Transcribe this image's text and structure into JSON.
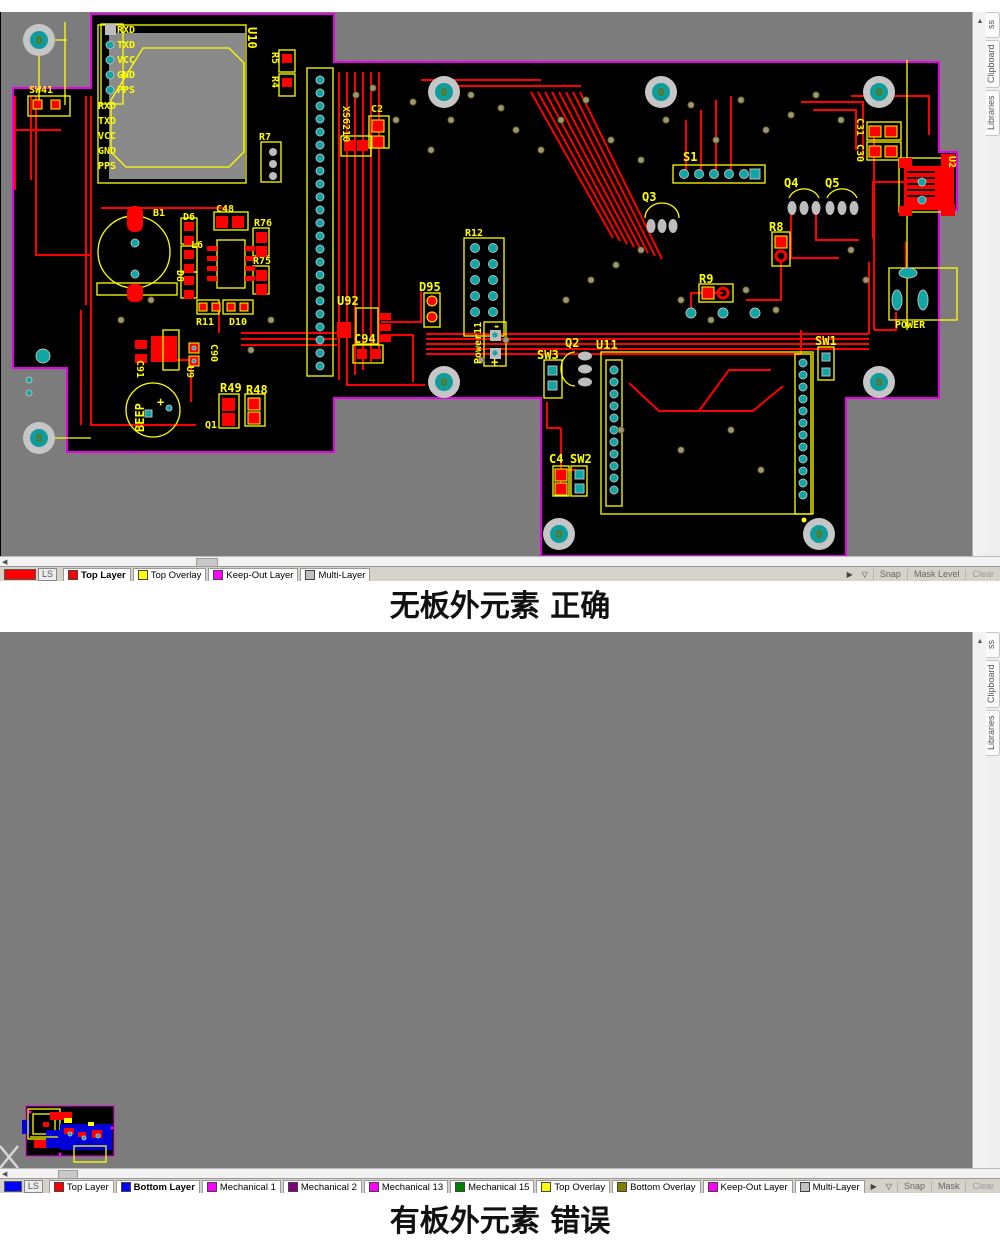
{
  "app": {
    "side_tabs": {
      "clipped": "ss",
      "clipboard": "Clipboard",
      "libraries": "Libraries"
    },
    "scroll": {
      "up": "▲",
      "left": "◀"
    },
    "buttons": {
      "snap": "Snap",
      "mask_level": "Mask Level",
      "clear": "Clear"
    },
    "icons": {
      "pick": "▶",
      "funnel": "▽"
    }
  },
  "panel1": {
    "caption": "无板外元素 正确",
    "indicator": "LS",
    "swatch": "#FF0000",
    "tabs": [
      {
        "label": "Top Layer",
        "color": "#FF0000",
        "active": true
      },
      {
        "label": "Top Overlay",
        "color": "#FFFF00",
        "active": false
      },
      {
        "label": "Keep-Out Layer",
        "color": "#FF00FF",
        "active": false
      },
      {
        "label": "Multi-Layer",
        "color": "#C0C0C0",
        "active": false
      }
    ]
  },
  "panel2": {
    "caption": "有板外元素 错误",
    "indicator": "LS",
    "swatch": "#0000FF",
    "tabs": [
      {
        "label": "Top Layer",
        "color": "#FF0000",
        "active": false
      },
      {
        "label": "Bottom Layer",
        "color": "#0000FF",
        "active": true
      },
      {
        "label": "Mechanical 1",
        "color": "#FF00FF",
        "active": false
      },
      {
        "label": "Mechanical 2",
        "color": "#800080",
        "active": false
      },
      {
        "label": "Mechanical 13",
        "color": "#FF00FF",
        "active": false
      },
      {
        "label": "Mechanical 15",
        "color": "#008000",
        "active": false
      },
      {
        "label": "Top Overlay",
        "color": "#FFFF00",
        "active": false
      },
      {
        "label": "Bottom Overlay",
        "color": "#808000",
        "active": false
      },
      {
        "label": "Keep-Out Layer",
        "color": "#FF00FF",
        "active": false
      },
      {
        "label": "Multi-Layer",
        "color": "#C0C0C0",
        "active": false
      }
    ]
  },
  "pcb": {
    "hole": "0",
    "labels": [
      "SW41",
      "RXD",
      "TXD",
      "VCC",
      "GND",
      "PPS",
      "RXD",
      "TXD",
      "VCC",
      "GND",
      "PPS",
      "U10",
      "R5",
      "R4",
      "R7",
      "XS6210",
      "C2",
      "B1",
      "D6",
      "C48",
      "R76",
      "L6",
      "D8",
      "R75",
      "R11",
      "D10",
      "C91",
      "U9",
      "C90",
      "BEEP",
      "R49",
      "R48",
      "Q1",
      "U92",
      "C94",
      "D95",
      "Power11",
      "-",
      "+",
      "S1",
      "Q3",
      "Q4",
      "Q5",
      "R8",
      "R9",
      "Q2",
      "U11",
      "SW3",
      "SW1",
      "C4",
      "SW2",
      "C31",
      "C30",
      "U2",
      "POWER",
      "R12",
      "+"
    ]
  }
}
